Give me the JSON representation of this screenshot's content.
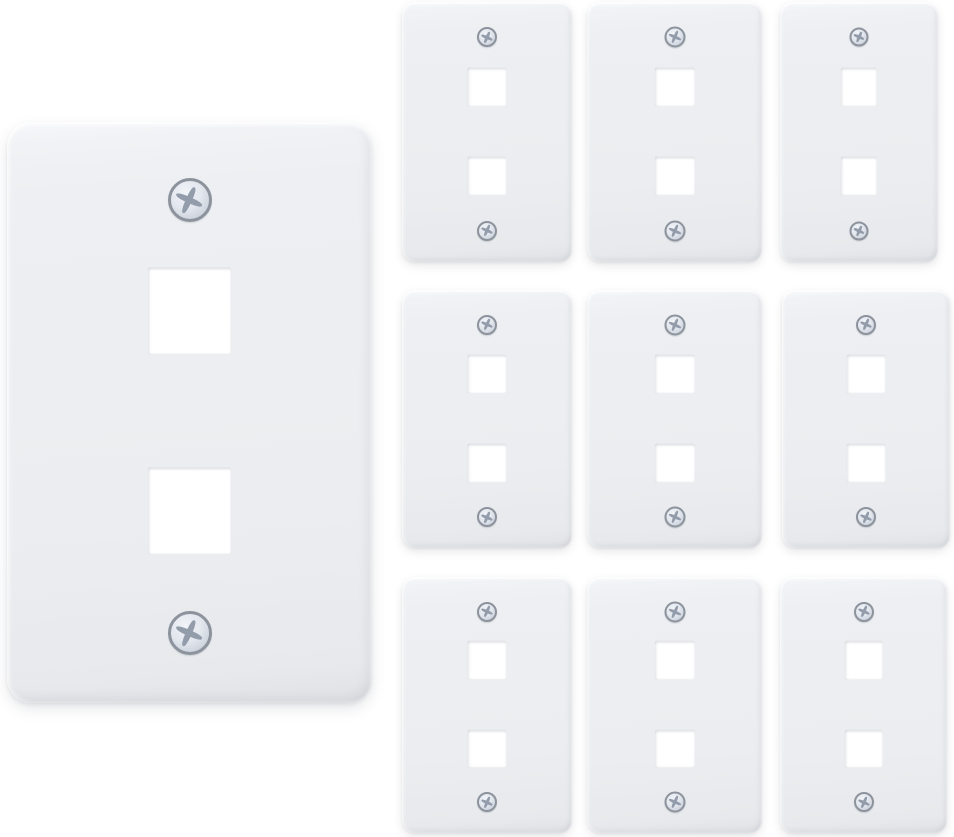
{
  "image": {
    "kind": "product-photo",
    "subject": "White 2-port keystone jack wall plates: one large hero plate at left, nine small plates in a 3x3 grid at right",
    "background_color": "#ffffff"
  },
  "colors": {
    "plate_face": "#edeff2",
    "plate_face_highlight": "#f7f8fa",
    "plate_edge_dark": "#dfe1e5",
    "port_fill": "#ffffff",
    "screw_ring": "#8d939c",
    "screw_head": "#e3e7ee",
    "screw_cross": "#939cab",
    "drop_shadow": "rgba(96,102,112,0.14)"
  },
  "plate_features": {
    "ports_per_plate": 2,
    "port_shape": "square",
    "screws_per_plate": 2,
    "screw_type": "phillips",
    "port_width_pct": 23,
    "port_height_pct": 15,
    "upper_port_center_pct": 32.5,
    "lower_port_center_pct": 67,
    "top_screw_center_pct": 13.5,
    "bottom_screw_center_pct": 88,
    "screw_diameter_pct_of_width": 12
  },
  "plates": [
    {
      "id": "wall-plate-large",
      "size": "large",
      "x": 7,
      "y": 122,
      "w": 365,
      "h": 581
    },
    {
      "id": "wall-plate-small-1",
      "size": "small",
      "x": 402,
      "y": 2,
      "w": 170,
      "h": 260
    },
    {
      "id": "wall-plate-small-2",
      "size": "small",
      "x": 587,
      "y": 2,
      "w": 175,
      "h": 260
    },
    {
      "id": "wall-plate-small-3",
      "size": "small",
      "x": 780,
      "y": 2,
      "w": 158,
      "h": 260
    },
    {
      "id": "wall-plate-small-4",
      "size": "small",
      "x": 402,
      "y": 290,
      "w": 170,
      "h": 258
    },
    {
      "id": "wall-plate-small-5",
      "size": "small",
      "x": 587,
      "y": 290,
      "w": 175,
      "h": 258
    },
    {
      "id": "wall-plate-small-6",
      "size": "small",
      "x": 782,
      "y": 290,
      "w": 168,
      "h": 258
    },
    {
      "id": "wall-plate-small-7",
      "size": "small",
      "x": 402,
      "y": 577,
      "w": 170,
      "h": 256
    },
    {
      "id": "wall-plate-small-8",
      "size": "small",
      "x": 587,
      "y": 577,
      "w": 175,
      "h": 256
    },
    {
      "id": "wall-plate-small-9",
      "size": "small",
      "x": 780,
      "y": 577,
      "w": 167,
      "h": 256
    }
  ]
}
